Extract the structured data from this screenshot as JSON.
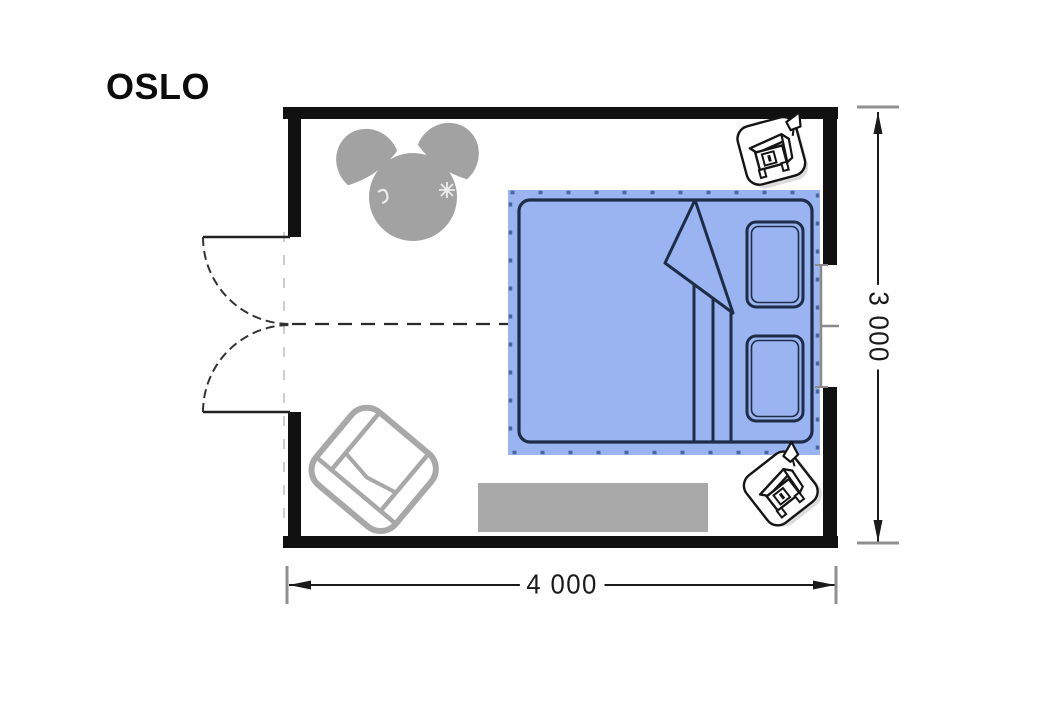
{
  "plan": {
    "title": "OSLO",
    "dimensions": {
      "width_label": "4 000",
      "height_label": "3 000"
    },
    "colors": {
      "wall": "#111111",
      "bed_highlight": "#9ab4f2",
      "bed_outline": "#1d2c47",
      "bed_tick": "#4a66a0",
      "furniture_gray": "#a2a2a2",
      "armchair_gray": "#a8a8a8",
      "rug_gray": "#a9a9a9",
      "window_line": "#8a8a8a",
      "dimension_line": "#1a1a1a",
      "dimension_cap": "#909090"
    },
    "furniture": [
      "round-table",
      "tub-chair-left",
      "tub-chair-right",
      "double-bed",
      "pillow-top",
      "pillow-bottom",
      "nightstand-with-lamp-top",
      "nightstand-with-lamp-bottom",
      "armchair",
      "rug"
    ],
    "features": [
      "double-swing-door-left-wall",
      "window-right-wall"
    ]
  }
}
